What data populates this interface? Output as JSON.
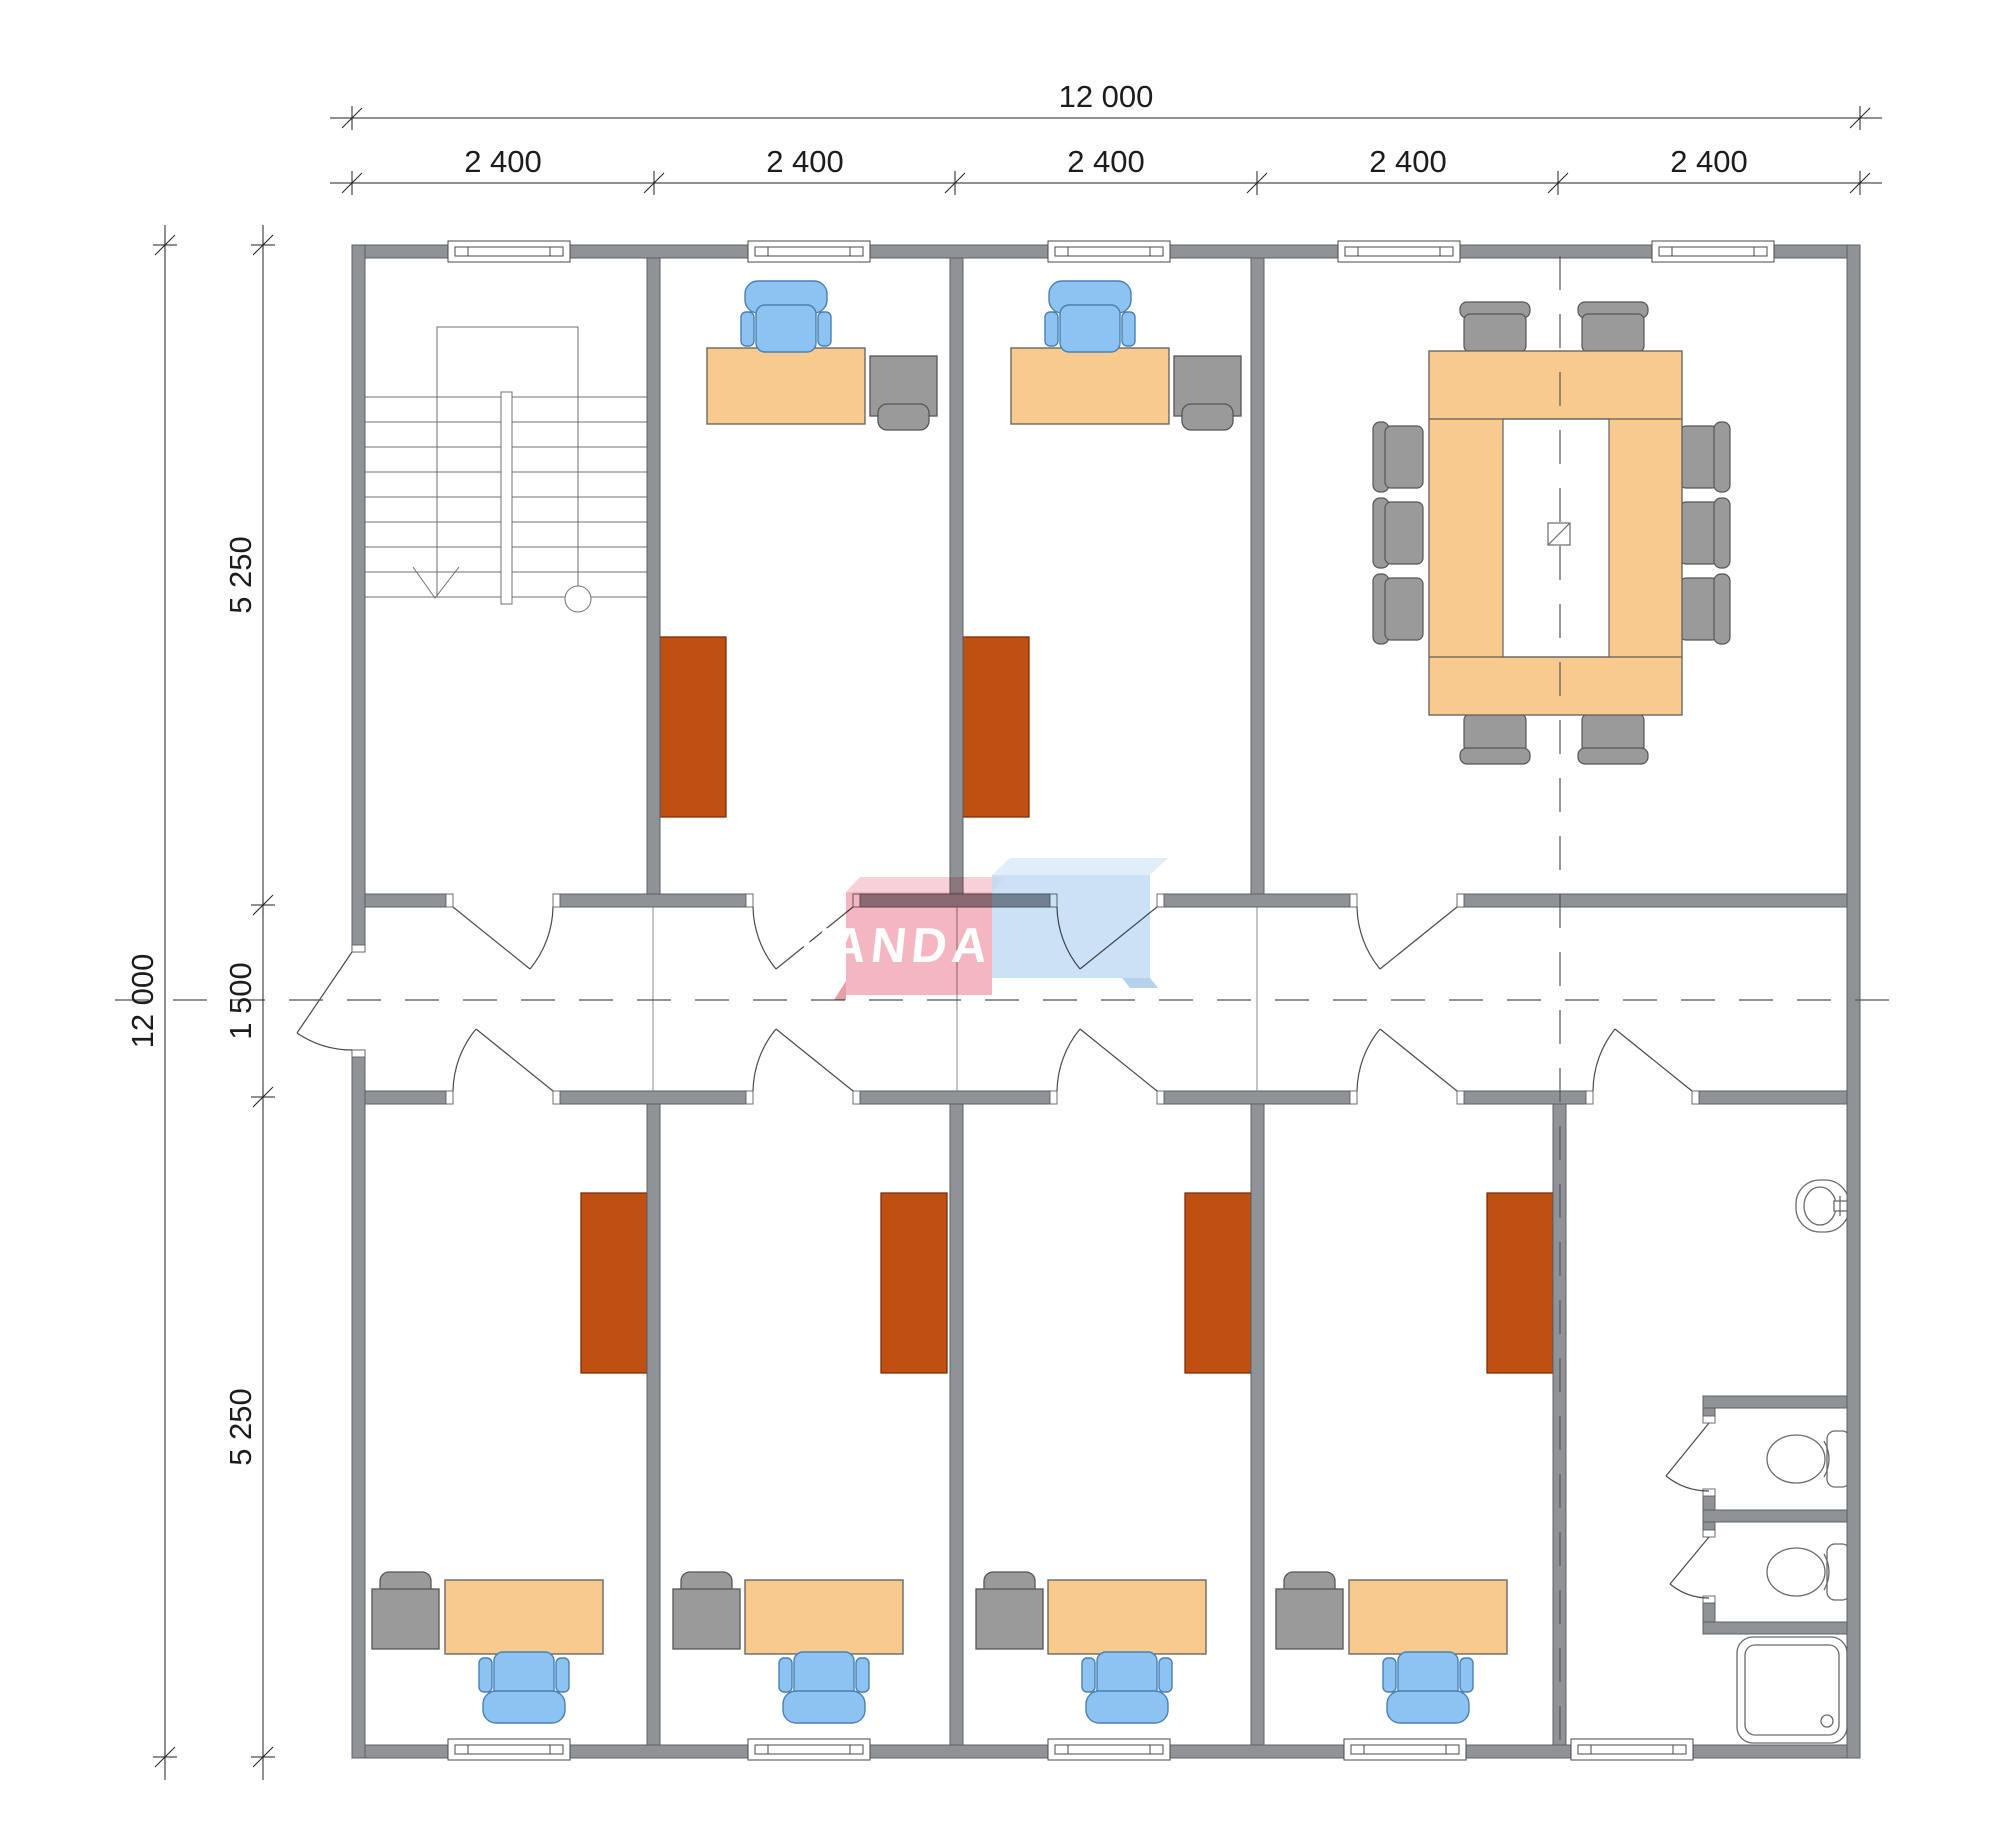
{
  "drawing": {
    "type": "floor-plan",
    "units": "mm"
  },
  "dimensions": {
    "top_total": "12 000",
    "top_segments": [
      "2 400",
      "2 400",
      "2 400",
      "2 400",
      "2 400"
    ],
    "left_total": "12 000",
    "left_segments": [
      "5 250",
      "1 500",
      "5 250"
    ]
  },
  "logo": {
    "text": "VANDA",
    "pink": "#f2aab6",
    "blue": "#c2dcf4"
  },
  "colors": {
    "wall": "#8f9296",
    "desk": "#f9ca8e",
    "chair_blue": "#8cc3f0",
    "equipment_gray": "#9a9a9a",
    "cabinet_brown": "#c05011",
    "meeting_chair": "#9a9a9a",
    "line": "#5e6065",
    "dimension_text": "#1c1c1c"
  }
}
